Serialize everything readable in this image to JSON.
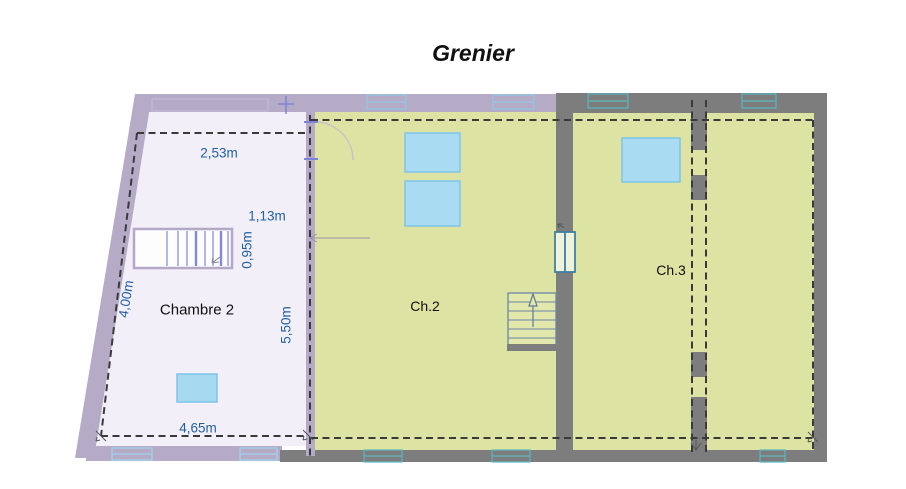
{
  "title": "Grenier",
  "rooms": {
    "chambre2": "Chambre 2",
    "ch2": "Ch.2",
    "ch3": "Ch.3"
  },
  "dimensions": {
    "chambre2_top_width": "2,53m",
    "stair_offset": "1,13m",
    "stair_width": "0,95m",
    "chambre2_left_height": "4,00m",
    "chambre2_right_height": "5,50m",
    "chambre2_bottom_width": "4,65m"
  },
  "colors": {
    "wall_lavender": "#b6abc7",
    "wall_gray": "#7d7d7d",
    "room_chambre2_fill": "#f2eff8",
    "room_green_fill": "#dde3a3",
    "skylight_fill": "#a9dbf2",
    "skylight_border": "#7fc4e8",
    "dashed_line": "#3a3a3a",
    "dimension_text": "#2160a6",
    "stair_tread_blue": "#8289d8",
    "window_teal": "#58b8c0",
    "window_lightblue": "#9fd4ee",
    "door_frame_blue": "#3f7fa6"
  }
}
